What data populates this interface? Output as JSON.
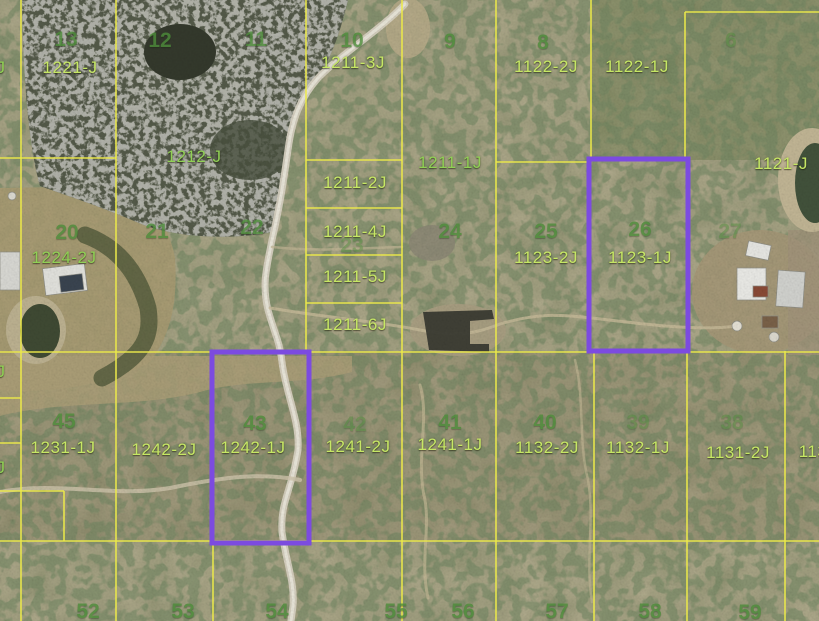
{
  "map": {
    "title": "aerial-parcel-map",
    "colors": {
      "parcel_line": "#ece94a",
      "parcel_label_yellow": "#c6e765",
      "parcel_label_green": "#90d055",
      "lot_number_green": "#4d8c3a",
      "selection_purple": "#7c4be0"
    },
    "parcel_labels": [
      {
        "text": "1221-J",
        "x": 70,
        "y": 68,
        "style": "yellow"
      },
      {
        "text": "1211-3J",
        "x": 353,
        "y": 63,
        "style": "yellow"
      },
      {
        "text": "1122-2J",
        "x": 546,
        "y": 67,
        "style": "yellow"
      },
      {
        "text": "1122-1J",
        "x": 637,
        "y": 67,
        "style": "yellow"
      },
      {
        "text": "1212-J",
        "x": 194,
        "y": 157,
        "style": "green"
      },
      {
        "text": "1211-1J",
        "x": 450,
        "y": 163,
        "style": "green"
      },
      {
        "text": "1121-J",
        "x": 781,
        "y": 164,
        "style": "yellow"
      },
      {
        "text": "1211-2J",
        "x": 355,
        "y": 183,
        "style": "yellow"
      },
      {
        "text": "1211-4J",
        "x": 355,
        "y": 232,
        "style": "yellow"
      },
      {
        "text": "1211-5J",
        "x": 355,
        "y": 277,
        "style": "yellow"
      },
      {
        "text": "1211-6J",
        "x": 355,
        "y": 325,
        "style": "yellow"
      },
      {
        "text": "1123-2J",
        "x": 546,
        "y": 258,
        "style": "yellow"
      },
      {
        "text": "1123-1J",
        "x": 640,
        "y": 258,
        "style": "yellow"
      },
      {
        "text": "1224-2J",
        "x": 64,
        "y": 258,
        "style": "green"
      },
      {
        "text": "1231-1J",
        "x": 63,
        "y": 448,
        "style": "yellow"
      },
      {
        "text": "1242-2J",
        "x": 164,
        "y": 450,
        "style": "yellow"
      },
      {
        "text": "1242-1J",
        "x": 253,
        "y": 448,
        "style": "yellow"
      },
      {
        "text": "1241-2J",
        "x": 358,
        "y": 447,
        "style": "yellow"
      },
      {
        "text": "1241-1J",
        "x": 450,
        "y": 445,
        "style": "yellow"
      },
      {
        "text": "1132-2J",
        "x": 547,
        "y": 448,
        "style": "yellow"
      },
      {
        "text": "1132-1J",
        "x": 638,
        "y": 448,
        "style": "yellow"
      },
      {
        "text": "1131-2J",
        "x": 738,
        "y": 453,
        "style": "yellow"
      },
      {
        "text": "113",
        "x": 813,
        "y": 452,
        "style": "yellow"
      },
      {
        "text": "J",
        "x": 1,
        "y": 68,
        "style": "green"
      },
      {
        "text": "J",
        "x": 1,
        "y": 372,
        "style": "green"
      },
      {
        "text": "J",
        "x": 1,
        "y": 468,
        "style": "green"
      }
    ],
    "lot_numbers": [
      {
        "text": "13",
        "x": 66,
        "y": 40,
        "faint": false
      },
      {
        "text": "12",
        "x": 160,
        "y": 41,
        "faint": false
      },
      {
        "text": "11",
        "x": 256,
        "y": 40,
        "faint": false
      },
      {
        "text": "10",
        "x": 352,
        "y": 41,
        "faint": false
      },
      {
        "text": "9",
        "x": 450,
        "y": 42,
        "faint": false
      },
      {
        "text": "8",
        "x": 543,
        "y": 43,
        "faint": false
      },
      {
        "text": "6",
        "x": 731,
        "y": 41,
        "faint": true
      },
      {
        "text": "20",
        "x": 67,
        "y": 233,
        "faint": false
      },
      {
        "text": "21",
        "x": 157,
        "y": 232,
        "faint": false
      },
      {
        "text": "22",
        "x": 252,
        "y": 228,
        "faint": false
      },
      {
        "text": "23",
        "x": 352,
        "y": 246,
        "faint": true
      },
      {
        "text": "24",
        "x": 450,
        "y": 232,
        "faint": false
      },
      {
        "text": "25",
        "x": 546,
        "y": 232,
        "faint": false
      },
      {
        "text": "26",
        "x": 640,
        "y": 230,
        "faint": false
      },
      {
        "text": "27",
        "x": 730,
        "y": 232,
        "faint": true
      },
      {
        "text": "45",
        "x": 64,
        "y": 422,
        "faint": false
      },
      {
        "text": "43",
        "x": 255,
        "y": 424,
        "faint": false
      },
      {
        "text": "42",
        "x": 355,
        "y": 425,
        "faint": true
      },
      {
        "text": "41",
        "x": 450,
        "y": 423,
        "faint": false
      },
      {
        "text": "40",
        "x": 545,
        "y": 423,
        "faint": false
      },
      {
        "text": "39",
        "x": 638,
        "y": 423,
        "faint": true
      },
      {
        "text": "38",
        "x": 732,
        "y": 423,
        "faint": true
      },
      {
        "text": "52",
        "x": 88,
        "y": 612,
        "faint": false
      },
      {
        "text": "53",
        "x": 183,
        "y": 612,
        "faint": false
      },
      {
        "text": "54",
        "x": 277,
        "y": 612,
        "faint": false
      },
      {
        "text": "55",
        "x": 396,
        "y": 612,
        "faint": false
      },
      {
        "text": "56",
        "x": 463,
        "y": 612,
        "faint": false
      },
      {
        "text": "57",
        "x": 557,
        "y": 612,
        "faint": false
      },
      {
        "text": "58",
        "x": 650,
        "y": 612,
        "faint": false
      },
      {
        "text": "59",
        "x": 750,
        "y": 613,
        "faint": false
      }
    ],
    "boundary_lines": {
      "verticals": [
        {
          "x": 21,
          "y1": 0,
          "y2": 621
        },
        {
          "x": 116,
          "y1": 0,
          "y2": 621
        },
        {
          "x": 213,
          "y1": 541,
          "y2": 621
        },
        {
          "x": 306,
          "y1": 0,
          "y2": 353
        },
        {
          "x": 402,
          "y1": 0,
          "y2": 621
        },
        {
          "x": 496,
          "y1": 0,
          "y2": 621
        },
        {
          "x": 591,
          "y1": 0,
          "y2": 161
        },
        {
          "x": 594,
          "y1": 351,
          "y2": 621
        },
        {
          "x": 685,
          "y1": 12,
          "y2": 161
        },
        {
          "x": 687,
          "y1": 351,
          "y2": 621
        },
        {
          "x": 785,
          "y1": 351,
          "y2": 621
        },
        {
          "x": 64,
          "y1": 491,
          "y2": 541
        }
      ],
      "horizontals": [
        {
          "y": 12,
          "x1": 685,
          "x2": 819
        },
        {
          "y": 158,
          "x1": 0,
          "x2": 116
        },
        {
          "y": 160,
          "x1": 306,
          "x2": 402
        },
        {
          "y": 162,
          "x1": 496,
          "x2": 591
        },
        {
          "y": 208,
          "x1": 306,
          "x2": 402
        },
        {
          "y": 255,
          "x1": 306,
          "x2": 402
        },
        {
          "y": 303,
          "x1": 306,
          "x2": 402
        },
        {
          "y": 352,
          "x1": 0,
          "x2": 819
        },
        {
          "y": 541,
          "x1": 0,
          "x2": 819
        },
        {
          "y": 398,
          "x1": 0,
          "x2": 21
        },
        {
          "y": 443,
          "x1": 0,
          "x2": 21
        },
        {
          "y": 491,
          "x1": 0,
          "x2": 64
        }
      ]
    },
    "selected_parcels": [
      {
        "parcel": "1242-1J",
        "x": 212,
        "y": 352,
        "w": 97,
        "h": 191
      },
      {
        "parcel": "1123-1J",
        "x": 589,
        "y": 159,
        "w": 99,
        "h": 192
      }
    ]
  }
}
